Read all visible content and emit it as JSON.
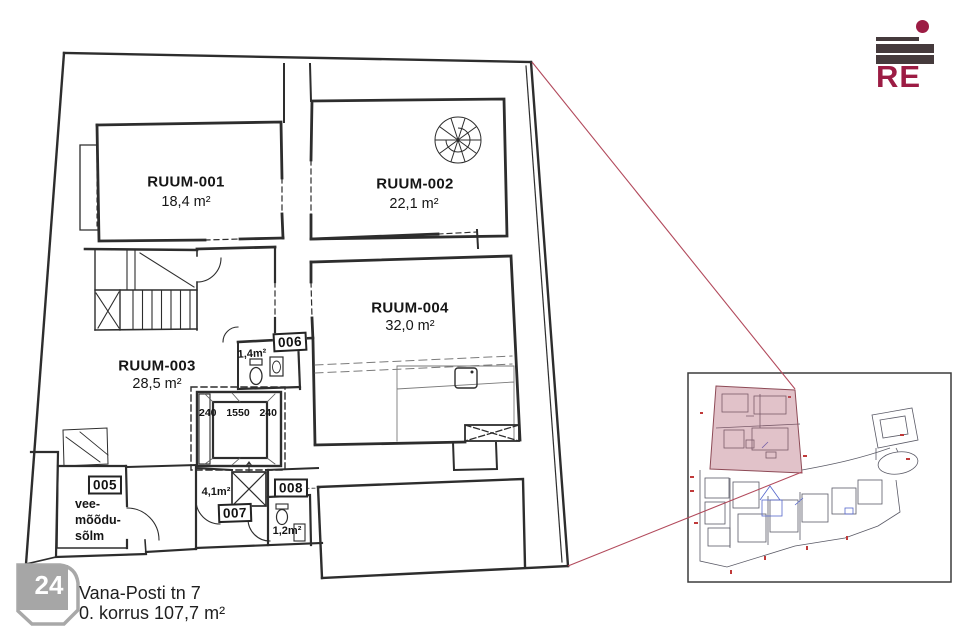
{
  "header": {
    "logo_text": "RE"
  },
  "floor_plan": {
    "rooms": [
      {
        "id": "RUUM-001",
        "area": "18,4 m²"
      },
      {
        "id": "RUUM-002",
        "area": "22,1 m²"
      },
      {
        "id": "RUUM-003",
        "area": "28,5 m²"
      },
      {
        "id": "RUUM-004",
        "area": "32,0 m²"
      }
    ],
    "small_rooms": {
      "r005": {
        "number": "005",
        "name_line1": "vee-",
        "name_line2": "mõõdu-",
        "name_line3": "sõlm"
      },
      "r006": {
        "number": "006",
        "area": "1,4m²"
      },
      "r007": {
        "number": "007",
        "area": "4,1m²"
      },
      "r008": {
        "number": "008",
        "area": "1,2m²"
      }
    },
    "lift": {
      "dim_left": "240",
      "dim_width": "1550",
      "dim_right": "240"
    }
  },
  "footer": {
    "page_number": "24",
    "address": "Vana-Posti tn 7",
    "floor_info": "0. korrus 107,7 m²"
  },
  "colors": {
    "accent": "#9c1c44",
    "logo_bar": "#453a3c",
    "leader_line": "#b24a5c",
    "inset_highlight": "#b05f72",
    "plan_line": "#2d2d2d"
  }
}
